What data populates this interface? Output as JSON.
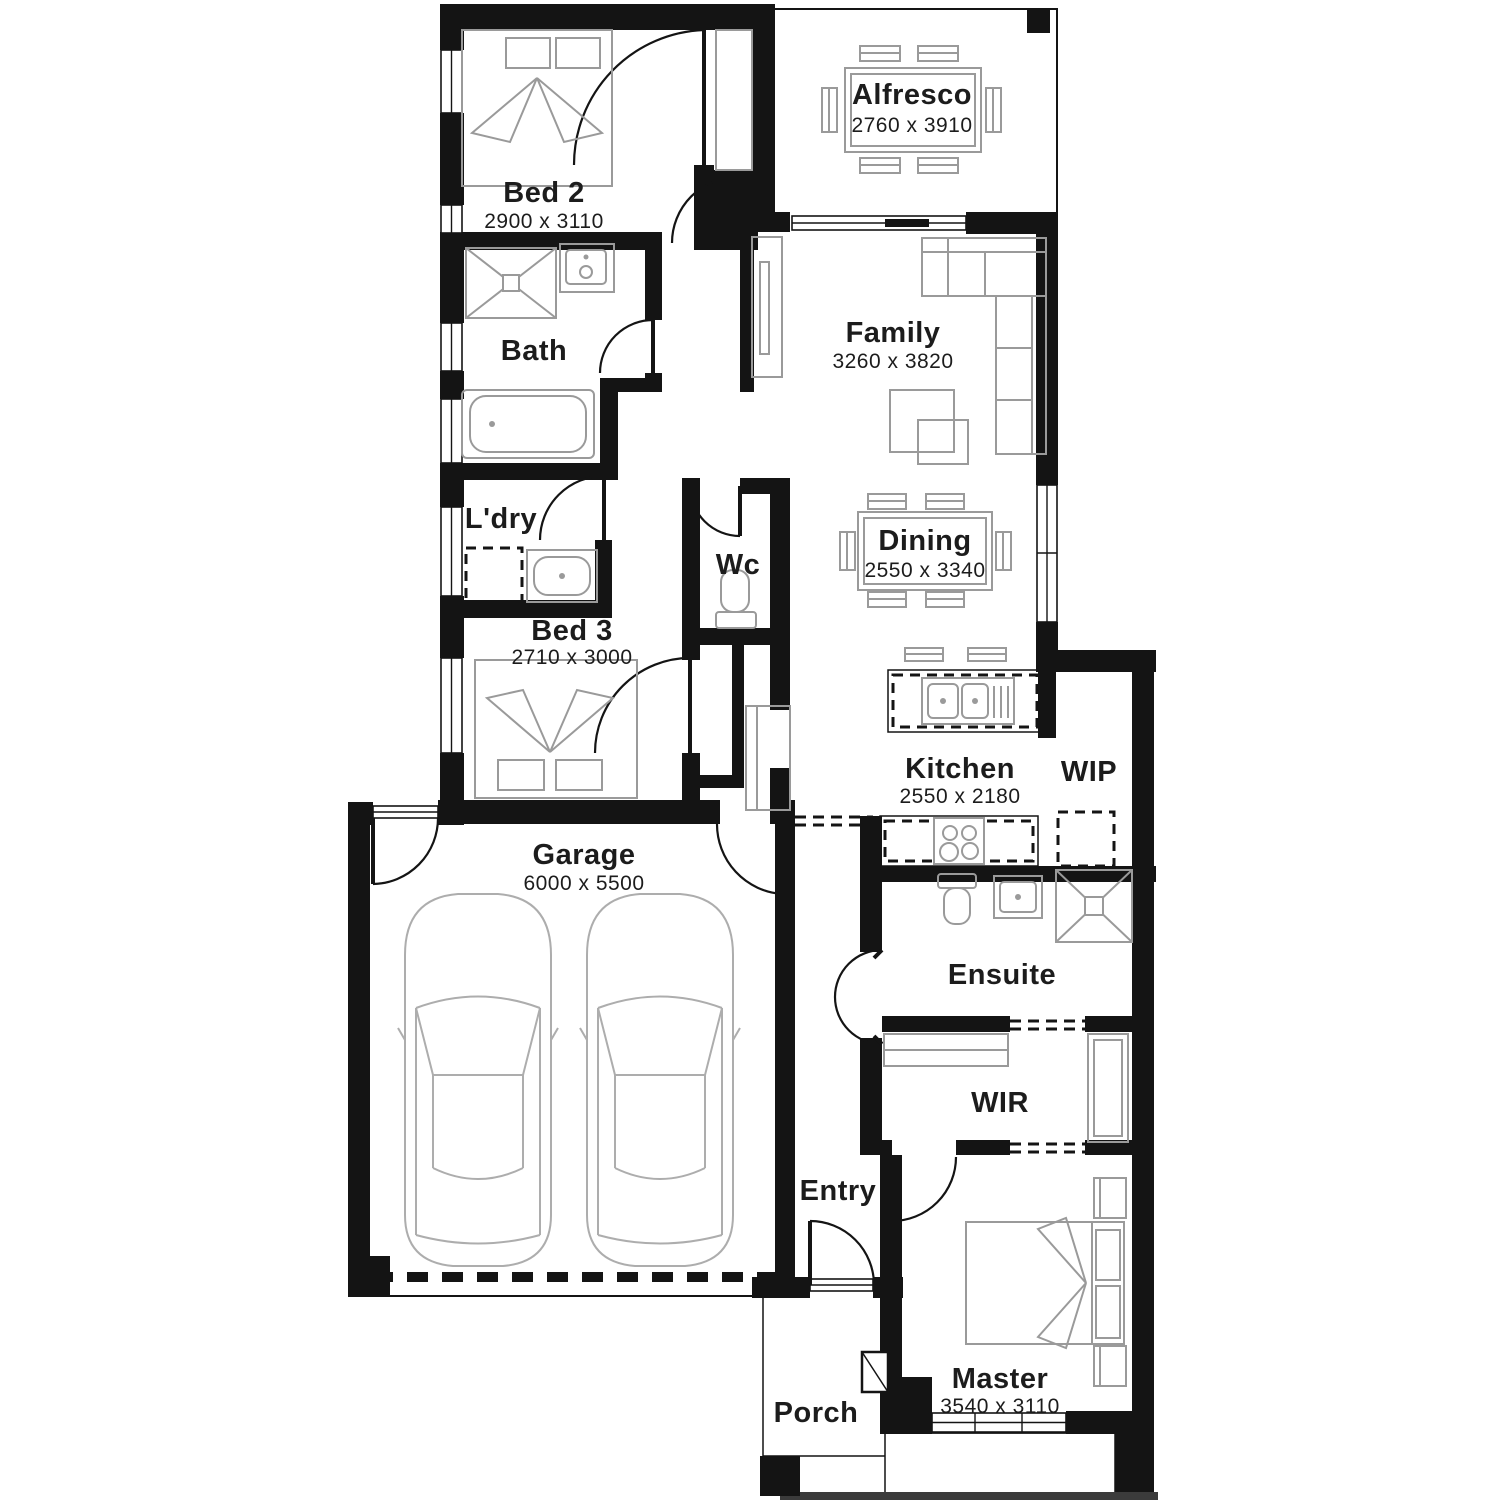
{
  "plan_type": "residential-floor-plan",
  "rooms": [
    {
      "id": "bed2",
      "name": "Bed 2",
      "dims": "2900 x 3110"
    },
    {
      "id": "alfresco",
      "name": "Alfresco",
      "dims": "2760 x 3910"
    },
    {
      "id": "bath",
      "name": "Bath",
      "dims": ""
    },
    {
      "id": "family",
      "name": "Family",
      "dims": "3260 x 3820"
    },
    {
      "id": "ldry",
      "name": "L'dry",
      "dims": ""
    },
    {
      "id": "wc",
      "name": "Wc",
      "dims": ""
    },
    {
      "id": "dining",
      "name": "Dining",
      "dims": "2550 x 3340"
    },
    {
      "id": "bed3",
      "name": "Bed 3",
      "dims": "2710 x 3000"
    },
    {
      "id": "kitchen",
      "name": "Kitchen",
      "dims": "2550 x 2180"
    },
    {
      "id": "wip",
      "name": "WIP",
      "dims": ""
    },
    {
      "id": "garage",
      "name": "Garage",
      "dims": "6000 x 5500"
    },
    {
      "id": "ensuite",
      "name": "Ensuite",
      "dims": ""
    },
    {
      "id": "wir",
      "name": "WIR",
      "dims": ""
    },
    {
      "id": "entry",
      "name": "Entry",
      "dims": ""
    },
    {
      "id": "master",
      "name": "Master",
      "dims": "3540 x 3110"
    },
    {
      "id": "porch",
      "name": "Porch",
      "dims": ""
    }
  ],
  "colors": {
    "wall": "#141414",
    "furniture": "#9a9a9a",
    "car_outline": "#adadad",
    "text": "#1c1c1c",
    "background": "#ffffff",
    "driveway_strip": "#3b3b3b"
  }
}
